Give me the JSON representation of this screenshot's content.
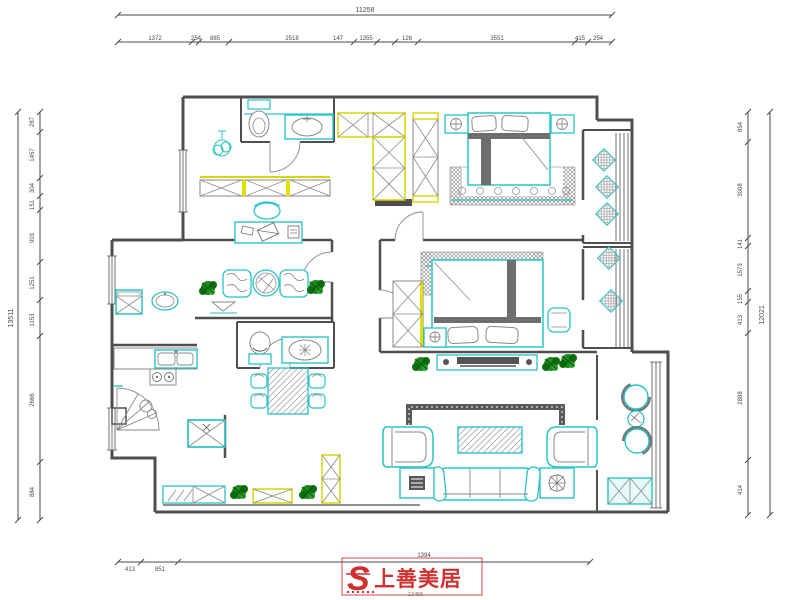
{
  "drawing": {
    "type": "apartment-floor-plan",
    "style": "CAD line drawing"
  },
  "dims": {
    "top_total": "11258",
    "top_segments": [
      "1372",
      "254",
      "885",
      "2518",
      "147",
      "1355",
      "126",
      "3551",
      "415",
      "254"
    ],
    "left_total": "13511",
    "left_segments": [
      "287",
      "1457",
      "304",
      "151",
      "903",
      "1251",
      "1153",
      "2666",
      "884"
    ],
    "right_total": "12021",
    "right_segments": [
      "854",
      "3008",
      "141",
      "1573",
      "155",
      "413",
      "2888",
      "414"
    ],
    "bottom_segments": [
      "413",
      "851"
    ],
    "bottom_center": "1394",
    "bottom_center_sub": "13455"
  },
  "logo": {
    "mark": "S",
    "brand": "上善美居"
  },
  "colors": {
    "wall": "#4f4f4f",
    "furniture_cyan": "#2ac4c4",
    "cabinet_yellow": "#d6d600",
    "plant_green": "#1d8a1d",
    "dark_fill": "#6e6e6e",
    "dim_text": "#4a4a4a",
    "logo_red": "#d03030"
  },
  "symbols": [
    "toilet-icon",
    "sink-icon",
    "pendant-lamp-icon",
    "wardrobe-x-icon",
    "bed-icon",
    "nightstand-lamp-icon",
    "rug-icon",
    "cushion-diamond-icon",
    "tv-console-icon",
    "armchair-icon",
    "sofa-icon",
    "coffee-table-icon",
    "round-chair-icon",
    "kitchen-sink-icon",
    "stove-icon",
    "fridge-icon",
    "dining-table-icon",
    "washing-machine-icon",
    "plant-icon",
    "shoe-cabinet-icon"
  ]
}
